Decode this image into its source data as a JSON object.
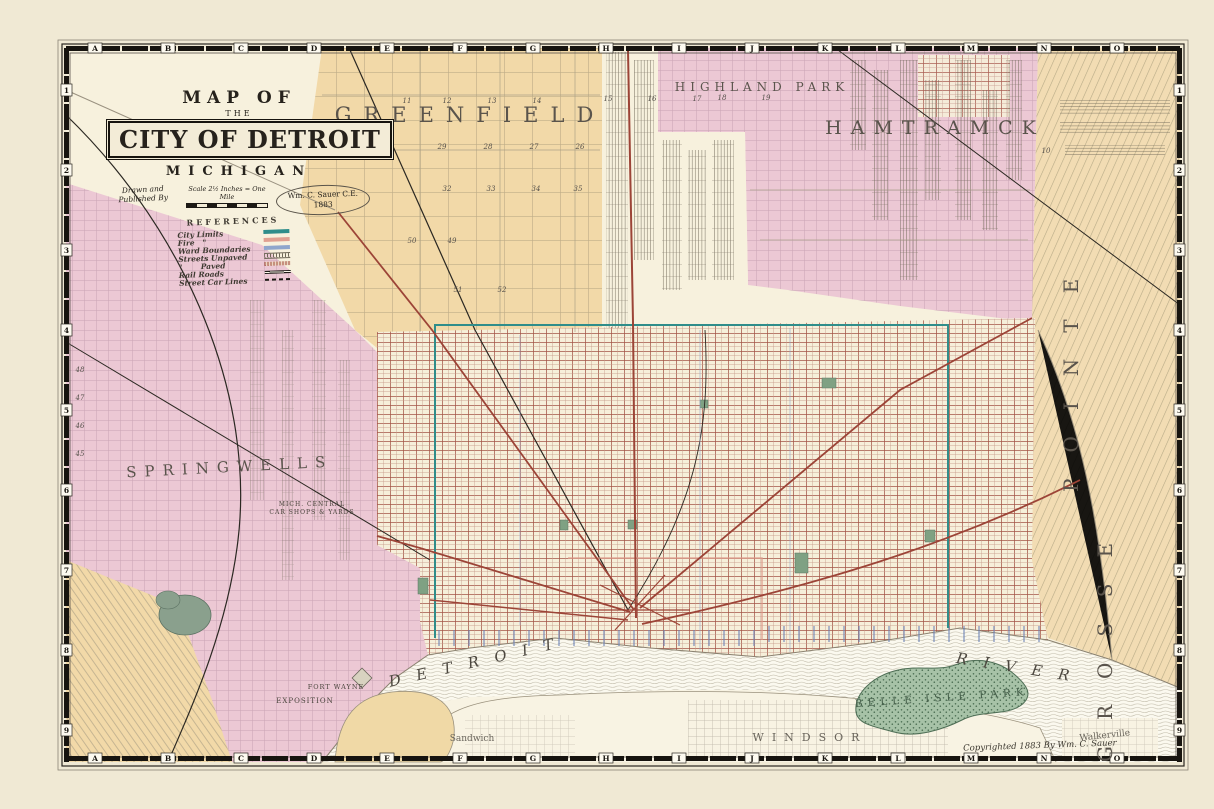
{
  "colors": {
    "paper": "#f0e9d4",
    "map_cream": "#f7f1dd",
    "pink": "#ecc8d4",
    "tan": "#f2d9a8",
    "river": "#fbf9ef",
    "canada_land": "#f8f3e3",
    "island_green": "#a7c2a7",
    "street_red": "#9c4437",
    "city_limits_teal": "#2f8d8a",
    "rail_black": "#2b2822"
  },
  "title_block": {
    "map_of": "MAP OF",
    "the": "THE",
    "city": "CITY OF DETROIT",
    "state": "MICHIGAN",
    "drawn1": "Drawn and",
    "drawn2": "Published By",
    "author": "Wm. C. Sauer C.E.",
    "year": "1883",
    "scale": "Scale 2½ Inches = One Mile"
  },
  "references": {
    "title": "REFERENCES",
    "items": [
      {
        "label": "City Limits"
      },
      {
        "label": "Fire   \""
      },
      {
        "label": "Ward Boundaries"
      },
      {
        "label": "Streets Unpaved"
      },
      {
        "label": "\"       Paved"
      },
      {
        "label": "Rail Roads"
      },
      {
        "label": "Street Car Lines"
      }
    ]
  },
  "labels": {
    "greenfield": "GREENFIELD",
    "highland_park": "HIGHLAND PARK",
    "hamtramck": "HAMTRAMCK",
    "springwells": "SPRINGWELLS",
    "grosse": "GROSSE",
    "pointe": "POINTE",
    "river_w": "DETROIT",
    "river_e": "RIVER",
    "windsor": "WINDSOR",
    "sandwich": "Sandwich",
    "walkerville": "Walkerville",
    "belle_isle": "BELLE ISLE PARK",
    "exposition": "EXPOSITION",
    "fort_wayne": "FORT WAYNE",
    "car_shops1": "MICH. CENTRAL",
    "car_shops2": "CAR SHOPS & YARDS",
    "copyright": "Copyrighted 1883 By Wm. C. Sauer"
  },
  "border": {
    "letters": [
      "A",
      "B",
      "C",
      "D",
      "E",
      "F",
      "G",
      "H",
      "I",
      "J",
      "K",
      "L",
      "M",
      "N",
      "O"
    ],
    "numbers": [
      "1",
      "2",
      "3",
      "4",
      "5",
      "6",
      "7",
      "8",
      "9"
    ]
  },
  "sections": [
    "11",
    "12",
    "13",
    "14",
    "15",
    "16",
    "17",
    "18",
    "19",
    "29",
    "28",
    "27",
    "26",
    "32",
    "33",
    "34",
    "35",
    "50",
    "49",
    "51",
    "52",
    "10",
    "48",
    "47",
    "46",
    "45"
  ]
}
